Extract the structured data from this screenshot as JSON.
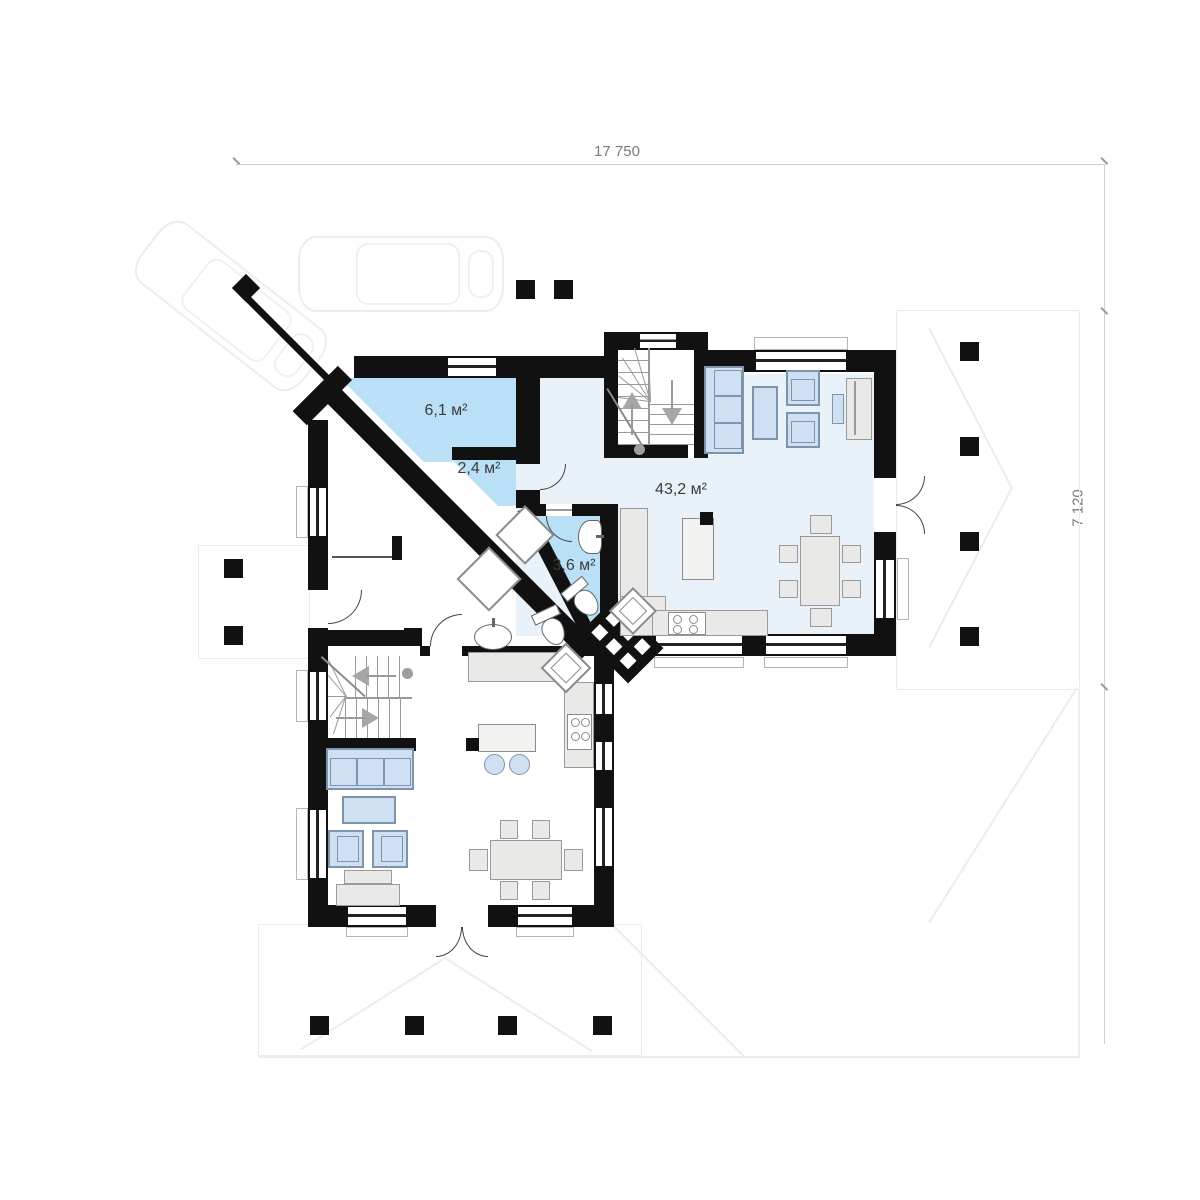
{
  "dimensions": {
    "width_label": "17 750",
    "depth_label": "7 120"
  },
  "rooms": [
    {
      "name": "hallway",
      "area_label": "6,1 м²"
    },
    {
      "name": "wardrobe",
      "area_label": "2,4 м²"
    },
    {
      "name": "bathroom",
      "area_label": "3,6 м²"
    },
    {
      "name": "living-kitchen",
      "area_label": "43,2 м²"
    }
  ],
  "icons": {
    "stairs_up_arrow": "up-arrow",
    "stairs_down_arrow": "down-arrow",
    "chimney": "flue-hatch-block",
    "pillar": "column-square"
  },
  "colors": {
    "wall": "#111111",
    "room_blue": "#b9e0f6",
    "room_light": "#e9f1f9",
    "furniture_blue": "#cfe0f2",
    "counter_gray": "#e9e9e7",
    "accent_border": "#7e94ac"
  }
}
